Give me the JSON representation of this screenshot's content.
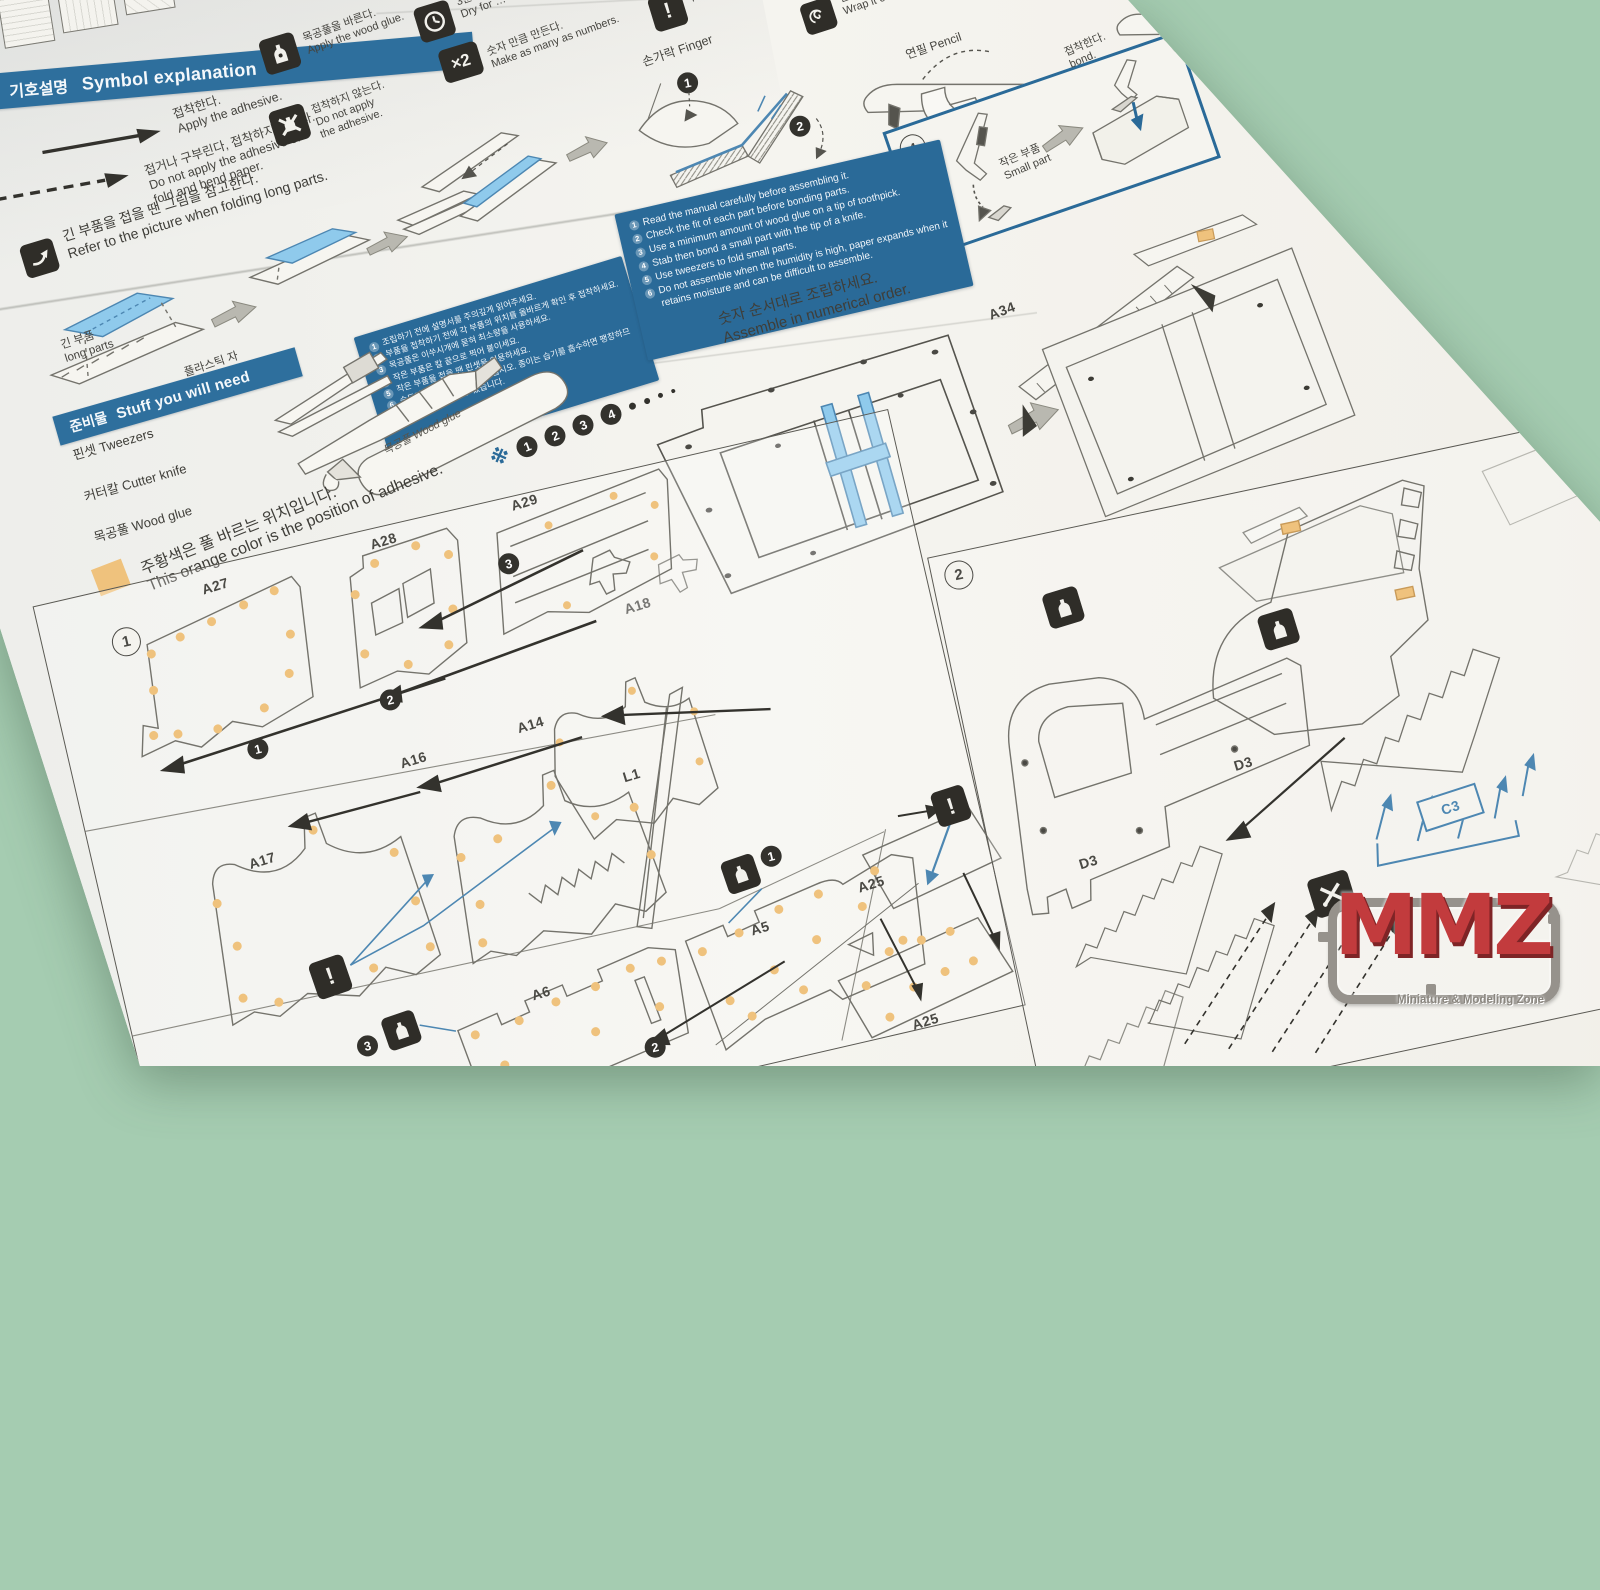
{
  "scene": {
    "background": "#a5ccb1",
    "paper": "#f2f1ec"
  },
  "colors": {
    "banner_blue": "#2e6f9d",
    "box_blue": "#2a6a98",
    "highlight_blue": "#8fcaec",
    "pointer_blue": "#4d87b2",
    "glue_orange": "#efc27d",
    "icon_dark": "#2f2d28",
    "line": "#74736c",
    "logo_red": "#c23b3d"
  },
  "symbol_section": {
    "title_ko": "기호설명",
    "title_en": "Symbol explanation",
    "apply": "접착한다.\nApply the adhesive.",
    "no_apply_fold": "접거나 구부린다, 접착하지 않는다.\nDo not apply the adhesive or\nfold and bend paper."
  },
  "icon_legend": {
    "wood_glue": "목공풀을 바른다.\nApply the wood glue.",
    "no_adhesive": "접착하지 않는다.\nDo not apply\nthe adhesive.",
    "dry": "3분 …\nDry for …",
    "multiply_symbol": "×2",
    "make_many": "숫자 만큼 만든다.\nMake as many as numbers.",
    "note": "Note …",
    "wrap": "연필에 …\nWrap it on a p…"
  },
  "fold_section": {
    "caption": "긴 부품을 접을 땐 그림을 참고한다.\nRefer to the picture when folding long parts.",
    "long_parts": "긴 부품\nlong parts",
    "plastic_ruler": "플라스틱 자\nPlastic ruler"
  },
  "finger_section": {
    "finger": "손가락 Finger"
  },
  "pencil_section": {
    "pencil": "연필 Pencil",
    "parts_a": "부품 parts",
    "parts_b": "부품 parts"
  },
  "bond_box": {
    "small_part": "작은 부품\nSmall part",
    "bond": "접착한다.\nbond."
  },
  "notes_ko": [
    "조립하기 전에 설명서를 주의깊게 읽어주세요.",
    "부품을 접착하기 전에 각 부품의 위치를 올바르게 확인 후 접착하세요.",
    "목공풀은 이쑤시개에 묻혀 최소량을 사용하세요.",
    "작은 부품은 칼 끝으로 찍어 붙이세요.",
    "작은 부품을 접을 땐 핀셋을 이용하세요.",
    "습도가 높을 땐 조립하지 마십시오. 종이는 습기를 흡수하면 팽창하므로 조립이 어려울 수 있습니다."
  ],
  "notes_en": [
    "Read the manual carefully before assembling it.",
    "Check the fit of each part before bonding parts.",
    "Use a minimum amount of wood glue on a tip of toothpick.",
    "Stab then bond a small part with the tip of a knife.",
    "Use tweezers to fold small parts.",
    "Do not assemble when the humidity is high, paper expands when it retains moisture and can be difficult to assemble."
  ],
  "order_note": {
    "marker": "※",
    "caption": "숫자 순서대로 조립하세요.\nAssemble in numerical order."
  },
  "tools": {
    "title_ko": "준비물",
    "title_en": "Stuff you will need",
    "tweezers": "핀셋 Tweezers",
    "cutter": "커터칼 Cutter knife",
    "glue": "목공풀 Wood glue",
    "tube_label": "목공풀 Wood glue"
  },
  "adhesive_note": {
    "caption": "주황색은 풀 바르는 위치입니다.\nThis orange color is the position of adhesive."
  },
  "steps": {
    "step1": "1",
    "step2": "2"
  },
  "markers": {
    "m1": "1",
    "m2": "2",
    "m3": "3",
    "m4": "4"
  },
  "part_labels": {
    "a34": "A34",
    "a27": "A27",
    "a28": "A28",
    "a29": "A29",
    "a18": "A18",
    "a17": "A17",
    "a16": "A16",
    "a14": "A14",
    "l1": "L1",
    "a6": "A6",
    "a5": "A5",
    "a25_top": "A25",
    "a25_bottom": "A25",
    "d3_right": "D3",
    "d3_left": "D3",
    "c3": "C3"
  },
  "watermark": {
    "logo": "MMZ",
    "tagline": "Miniature & Modeling Zone"
  }
}
